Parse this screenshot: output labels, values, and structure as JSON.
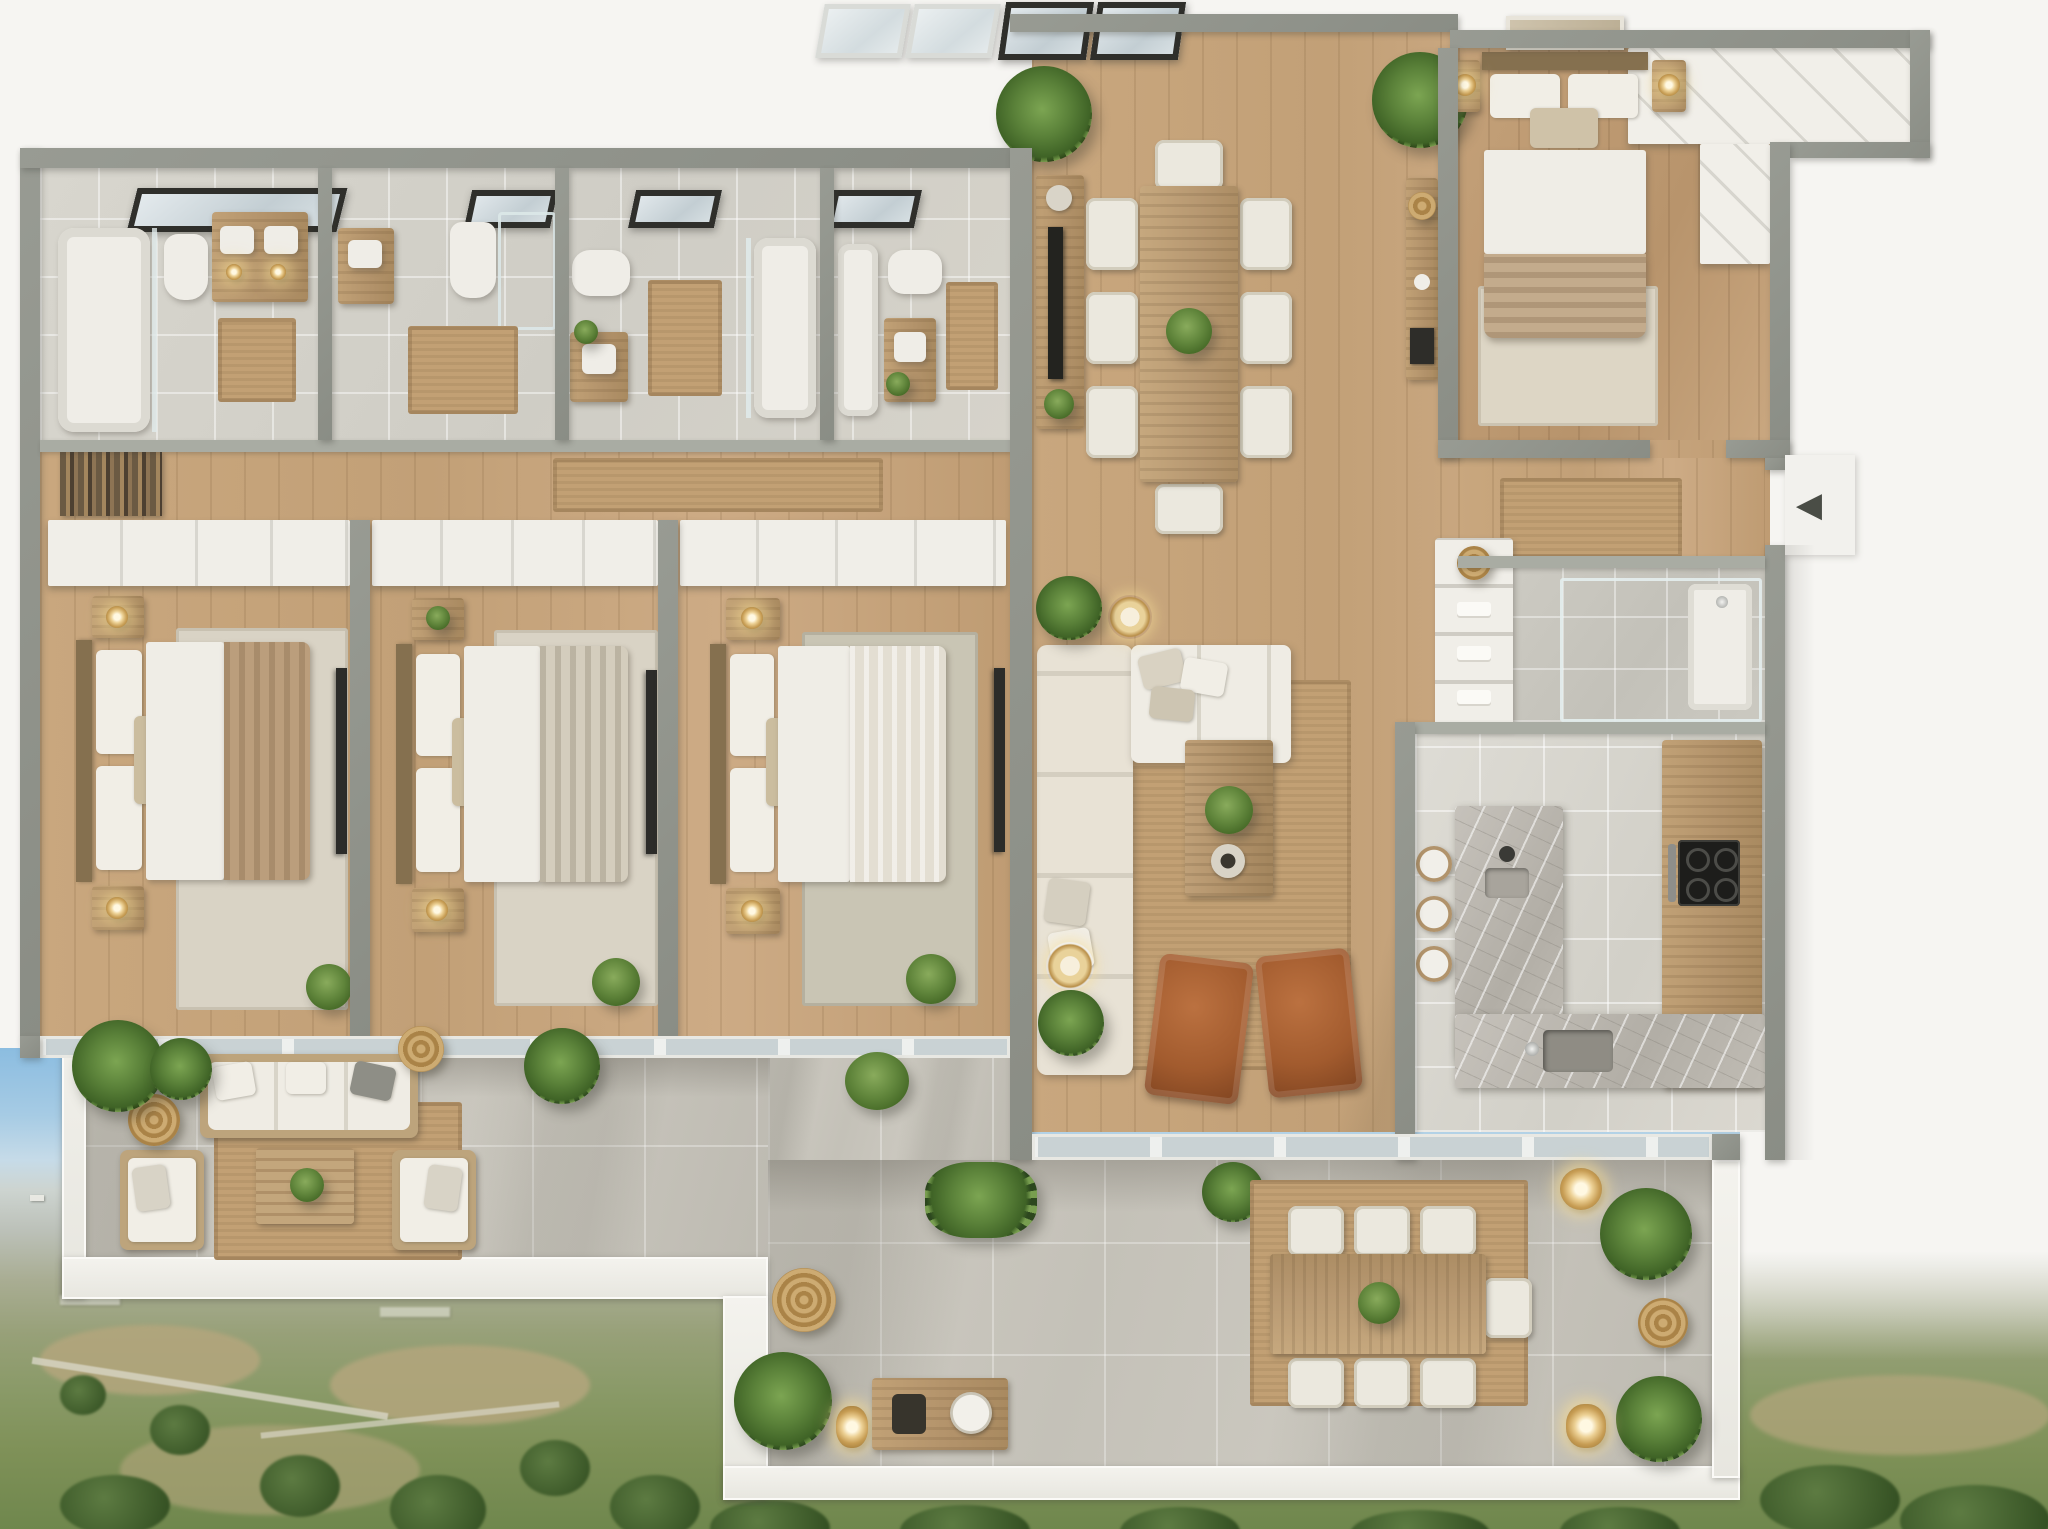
{
  "meta": {
    "title": "Photorealistic 3D floor plan render — penthouse apartment, top-down view",
    "render_type": "architectural 3D floor plan",
    "visible_text": "none"
  },
  "palette": {
    "background_white": "#f6f5f2",
    "outer_wall_gray": "#8e918a",
    "inner_wall_gray": "#a9aca3",
    "wood_floor": "#c8a67e",
    "bathroom_tile": "#d6d4cc",
    "terrace_stone": "#cbc8bf",
    "jute_rug": "#c2a074",
    "cream_upholstery": "#e7e1d4",
    "cognac_leather": "#a3582f",
    "marble_island": "#b8b4ac",
    "plant_green": "#557d35",
    "gold_accent": "#c9a45c",
    "sky_blue": "#8abce0",
    "countryside_green": "#7f9158"
  },
  "entry": {
    "arrow_glyph": "◀",
    "label": "Apartment entrance with direction arrow"
  },
  "counts": {
    "bedrooms": 4,
    "bathrooms": 4,
    "dining_chairs": 8,
    "terrace_dining_chairs": 7,
    "bar_stools": 3,
    "skylights": 6,
    "leather_armchairs": 2
  },
  "rooms": {
    "bathroom1": {
      "label": "Bathroom 1 — bathtub, toilet, double vanity, skylight, bath mat"
    },
    "bathroom2": {
      "label": "Bathroom 2 — vanity, toilet, shower, skylight, bath mat"
    },
    "bathroom3": {
      "label": "Bathroom 3 — toilet, vanity with plant, glazed bathtub, skylight, bath mat"
    },
    "bathroom4": {
      "label": "Bathroom 4 — bathtub, toilet, vanity with plant, skylight, bath mat"
    },
    "corridor": {
      "label": "Corridor with runner rug and bookshelf"
    },
    "bedroom1": {
      "label": "Bedroom 1 — double bed, nightstands with lamps, wardrobe, rug, TV"
    },
    "bedroom2": {
      "label": "Bedroom 2 — double bed, nightstands with lamps, wardrobe, rug, TV"
    },
    "bedroom3": {
      "label": "Bedroom 3 — double bed, nightstands with lamps, wardrobe, rug, TV"
    },
    "master": {
      "label": "Master bedroom — bed, art frame, gold lamps, L-shaped wardrobe, rug"
    },
    "dining": {
      "label": "Dining room — 8-seat wooden table, sideboard with TV, palms, skylights"
    },
    "living": {
      "label": "Living room — L-shaped cream sofa, coffee table, two leather armchairs, jute rug, floor lamps"
    },
    "hall": {
      "label": "Entry hall — runner rug, console with woven tray, shelving unit"
    },
    "shower": {
      "label": "Shower room with glass enclosure"
    },
    "kitchen": {
      "label": "Kitchen — marble island, three bar stools, cooktop, sink, counters"
    },
    "terrace_lounge": {
      "label": "Terrace lounge — outdoor sofa, two armchairs, slatted coffee table, jute rug, palms, woven poufs"
    },
    "terrace_dining": {
      "label": "Terrace dining — wooden table with seven chairs, jute rug, palms, lanterns, bench"
    },
    "landscape": {
      "label": "Aerial countryside view — blue sky, distant town, fields, olive groves, lawn"
    }
  }
}
